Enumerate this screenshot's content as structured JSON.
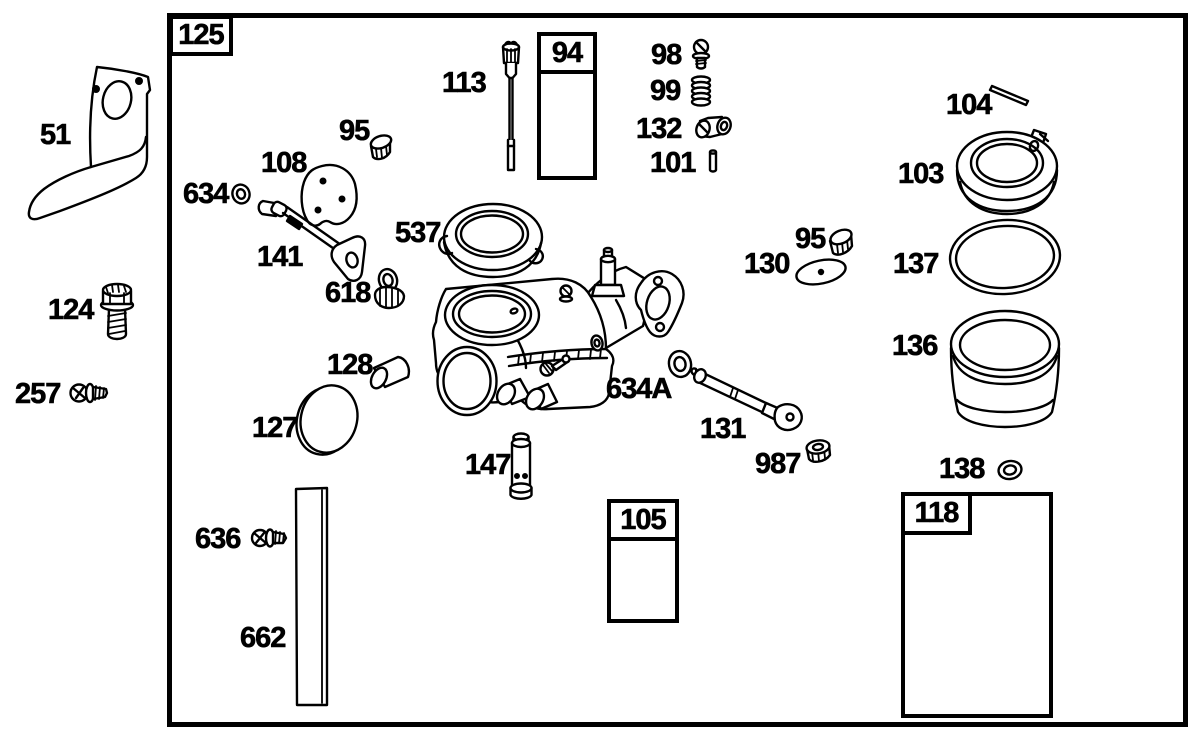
{
  "document": {
    "kind": "exploded-parts-diagram",
    "colors": {
      "ink": "#000000",
      "paper": "#ffffff"
    }
  },
  "frame": {
    "label": "125"
  },
  "group_boxes": {
    "box94": {
      "label": "94",
      "contents": [
        "needle-valve-screw",
        "spring"
      ]
    },
    "box105": {
      "label": "105",
      "contents": [
        "inlet-needle",
        "spring-clip"
      ]
    },
    "box118": {
      "label": "118",
      "contents": [
        "bolt-with-coil-top",
        "o-ring",
        "o-ring",
        "spring",
        "needle-valve"
      ]
    }
  },
  "part_labels": [
    {
      "text": "51",
      "icon": "bracket-plate",
      "x": 40,
      "y": 121
    },
    {
      "text": "124",
      "icon": "flange-bolt",
      "x": 48,
      "y": 296
    },
    {
      "text": "257",
      "icon": "hex-washer-screw",
      "x": 15,
      "y": 380
    },
    {
      "text": "634",
      "icon": "washer",
      "x": 183,
      "y": 180
    },
    {
      "text": "108",
      "icon": "plate-with-holes",
      "x": 261,
      "y": 149
    },
    {
      "text": "95",
      "icon": "welch-plug",
      "x": 339,
      "y": 117
    },
    {
      "text": "141",
      "icon": "lever-rod",
      "x": 257,
      "y": 243
    },
    {
      "text": "537",
      "icon": "ring-gasket",
      "x": 395,
      "y": 219
    },
    {
      "text": "618",
      "icon": "shaft-seal",
      "x": 325,
      "y": 279
    },
    {
      "text": "113",
      "icon": "metering-needle",
      "x": 442,
      "y": 69
    },
    {
      "text": "98",
      "icon": "slotted-screw",
      "x": 651,
      "y": 41
    },
    {
      "text": "99",
      "icon": "spring",
      "x": 650,
      "y": 77
    },
    {
      "text": "132",
      "icon": "bushing",
      "x": 636,
      "y": 115
    },
    {
      "text": "101",
      "icon": "pin",
      "x": 650,
      "y": 149
    },
    {
      "text": "104",
      "icon": "hinge-pin",
      "x": 946,
      "y": 91
    },
    {
      "text": "103",
      "icon": "float-ring",
      "x": 898,
      "y": 160
    },
    {
      "text": "95",
      "icon": "welch-plug",
      "x": 795,
      "y": 225
    },
    {
      "text": "130",
      "icon": "oval-disc",
      "x": 744,
      "y": 250
    },
    {
      "text": "137",
      "icon": "o-ring",
      "x": 893,
      "y": 250
    },
    {
      "text": "136",
      "icon": "fuel-bowl",
      "x": 892,
      "y": 332
    },
    {
      "text": "128",
      "icon": "tube",
      "x": 327,
      "y": 351
    },
    {
      "text": "127",
      "icon": "oval-disc",
      "x": 252,
      "y": 414
    },
    {
      "text": "634A",
      "icon": "washer",
      "x": 606,
      "y": 375
    },
    {
      "text": "131",
      "icon": "lever-rod",
      "x": 700,
      "y": 415
    },
    {
      "text": "987",
      "icon": "seal-cup",
      "x": 755,
      "y": 450
    },
    {
      "text": "147",
      "icon": "standpipe",
      "x": 465,
      "y": 451
    },
    {
      "text": "138",
      "icon": "o-ring",
      "x": 939,
      "y": 455
    },
    {
      "text": "636",
      "icon": "hex-washer-screw",
      "x": 195,
      "y": 525
    },
    {
      "text": "662",
      "icon": "strip",
      "x": 240,
      "y": 624
    }
  ]
}
